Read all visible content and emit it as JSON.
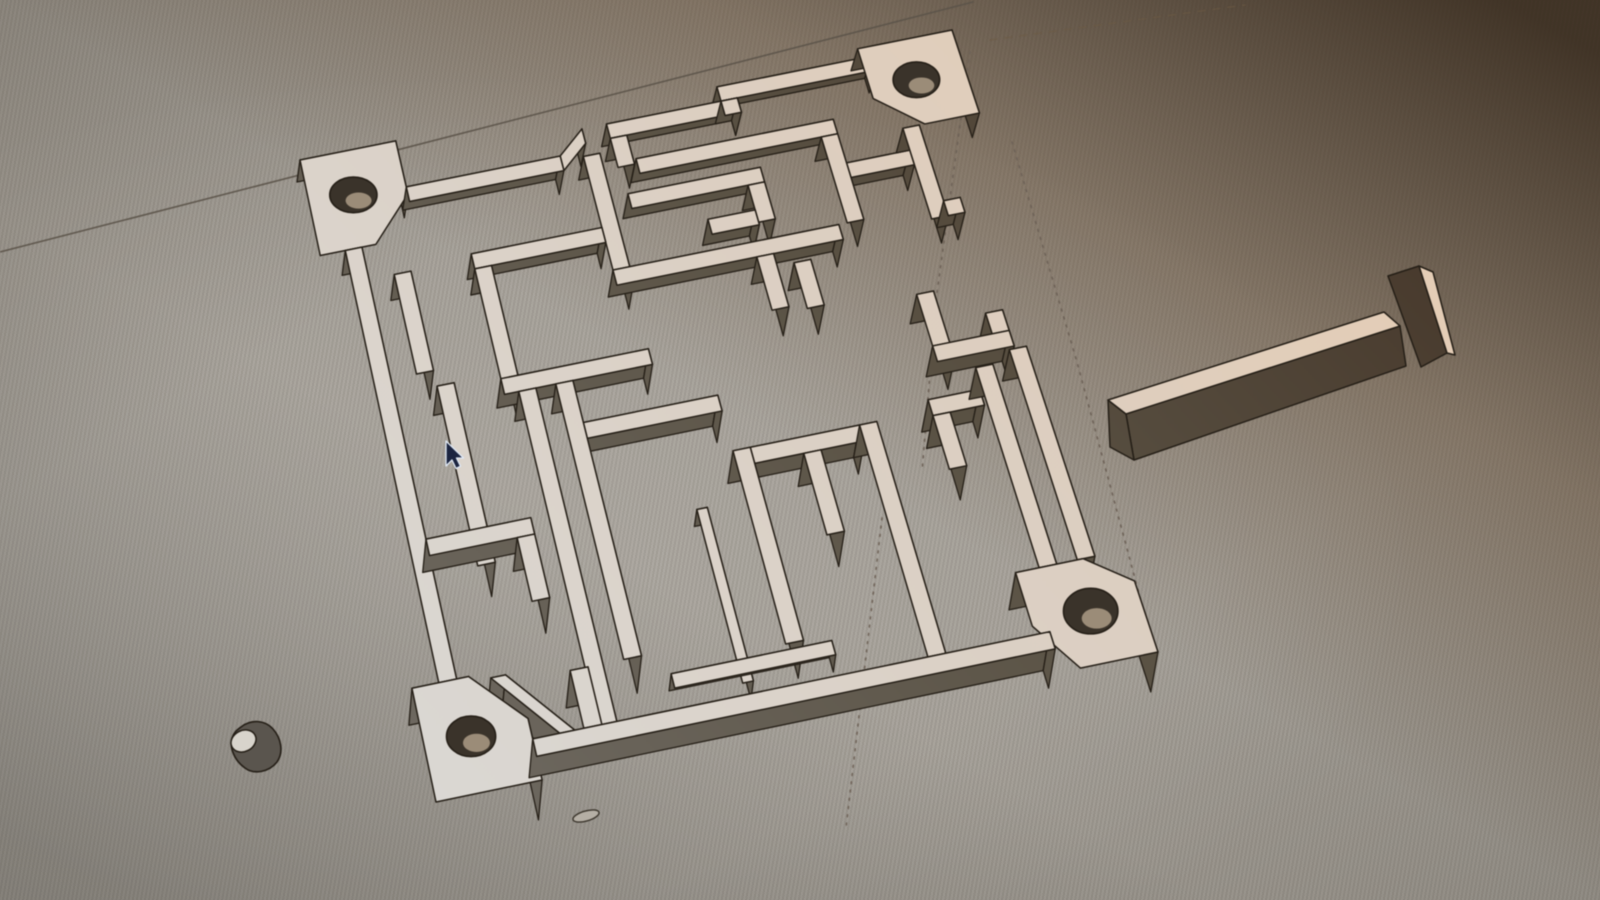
{
  "scene": {
    "board": {
      "size": 12,
      "quad": [
        [
          300,
          160
        ],
        [
          952,
          30
        ],
        [
          1158,
          652
        ],
        [
          436,
          802
        ]
      ],
      "ext": {
        "ex0": 3,
        "exu": 0.35,
        "ey0": 22,
        "eyv": 1.5
      }
    },
    "colors": {
      "outline": "#251f17",
      "hole": "#3a332a",
      "hole_glint": "#b4a38c",
      "top_stops": [
        [
          0,
          "#e6cdb4"
        ],
        [
          0.45,
          "#dccfc2"
        ],
        [
          1,
          "#dad8d4"
        ]
      ],
      "side_stops": [
        [
          0,
          "#46372a"
        ],
        [
          0.45,
          "#5a5244"
        ],
        [
          1,
          "#6f6a62"
        ]
      ],
      "cursor_fill": "#1b2440",
      "cursor_stroke": "#dfe8f4",
      "cyl_body": "#5a554e",
      "cyl_cap": "#d8d4cc",
      "oval_fill": "#b5afa5",
      "oval_stroke": "#3b352c"
    },
    "ground_lines": [
      {
        "name": "horizon-line",
        "pts": [
          [
            0,
            252
          ],
          [
            973,
            2
          ]
        ],
        "stroke": "#5b5349",
        "w": 1.6,
        "dash": "",
        "op": 0.9
      },
      {
        "name": "horizon-line-faint",
        "pts": [
          [
            990,
            40
          ],
          [
            1245,
            5
          ]
        ],
        "stroke": "#6d5b44",
        "w": 1.4,
        "dash": "7 8",
        "op": 0.55
      },
      {
        "name": "guide-line-dotted-1",
        "pts": [
          [
            970,
            52
          ],
          [
            936,
            300
          ],
          [
            922,
            472
          ]
        ],
        "stroke": "#6e6257",
        "w": 1.7,
        "dash": "1.8 6.5",
        "op": 0.95
      },
      {
        "name": "guide-line-dotted-2",
        "pts": [
          [
            1012,
            142
          ],
          [
            1077,
            362
          ],
          [
            1141,
            601
          ]
        ],
        "stroke": "#6e6257",
        "w": 1.7,
        "dash": "1.8 6.5",
        "op": 0.95
      },
      {
        "name": "guide-line-dotted-3",
        "pts": [
          [
            882,
            518
          ],
          [
            846,
            828
          ]
        ],
        "stroke": "#6e6257",
        "w": 1.7,
        "dash": "1.8 6.5",
        "op": 0.9
      }
    ],
    "pieces": [
      {
        "name": "corner-block-top-left",
        "poly": [
          [
            0,
            0
          ],
          [
            1.75,
            0
          ],
          [
            1.75,
            1.1
          ],
          [
            1.0,
            1.95
          ],
          [
            0,
            1.95
          ]
        ],
        "hole": [
          0.8,
          0.9,
          0.42
        ]
      },
      {
        "name": "corner-block-top-right",
        "poly": [
          [
            10.25,
            0
          ],
          [
            12,
            0
          ],
          [
            12,
            1.75
          ],
          [
            11.0,
            1.75
          ],
          [
            10.25,
            1.05
          ]
        ],
        "hole": [
          11.1,
          0.85,
          0.42
        ]
      },
      {
        "name": "corner-block-bottom-right",
        "poly": [
          [
            10.15,
            10.2
          ],
          [
            11.3,
            10.2
          ],
          [
            12,
            10.75
          ],
          [
            12,
            12
          ],
          [
            10.7,
            12
          ],
          [
            10.15,
            11.15
          ]
        ],
        "hole": [
          11.15,
          11.1,
          0.45
        ]
      },
      {
        "name": "corner-block-bottom-left",
        "poly": [
          [
            0,
            10.05
          ],
          [
            0.95,
            10.05
          ],
          [
            1.75,
            10.95
          ],
          [
            1.75,
            12
          ],
          [
            0,
            12
          ]
        ],
        "hole": [
          0.78,
          11.05,
          0.4
        ]
      },
      {
        "name": "perimeter-wall-top-left",
        "rect": [
          1.75,
          0.95,
          4.55,
          1.25
        ]
      },
      {
        "name": "perimeter-wall-top-jog",
        "poly": [
          [
            4.55,
            0.95
          ],
          [
            5.05,
            0.5
          ],
          [
            5.05,
            0.8
          ],
          [
            4.55,
            1.25
          ]
        ]
      },
      {
        "name": "perimeter-wall-top-mid",
        "rect": [
          5.5,
          0.5,
          7.9,
          0.8
        ]
      },
      {
        "name": "entrance-step-wall",
        "rect": [
          5.5,
          0.8,
          5.8,
          1.4
        ]
      },
      {
        "name": "perimeter-wall-top-right",
        "rect": [
          7.6,
          0.2,
          10.45,
          0.5
        ]
      },
      {
        "name": "perimeter-wall-top-step",
        "rect": [
          7.6,
          0.5,
          7.9,
          0.8
        ]
      },
      {
        "name": "maze-wall-inner-top",
        "rect": [
          5.85,
          1.3,
          9.45,
          1.6
        ]
      },
      {
        "name": "perimeter-wall-left",
        "rect": [
          0.45,
          1.95,
          0.75,
          10.05
        ]
      },
      {
        "name": "perimeter-wall-right-upper",
        "rect": [
          10.6,
          1.75,
          10.9,
          3.6
        ]
      },
      {
        "name": "perimeter-wall-right-step",
        "rect": [
          10.9,
          3.3,
          11.2,
          3.6
        ]
      },
      {
        "name": "right-u-wall-horizontal",
        "rect": [
          9.95,
          5.95,
          11.3,
          6.25
        ]
      },
      {
        "name": "right-u-wall-left",
        "rect": [
          9.95,
          4.95,
          10.25,
          6.25
        ]
      },
      {
        "name": "right-u-wall-right",
        "rect": [
          11.0,
          5.55,
          11.3,
          6.25
        ]
      },
      {
        "name": "perimeter-wall-right-lower-a",
        "rect": [
          10.55,
          6.5,
          10.85,
          10.2
        ]
      },
      {
        "name": "perimeter-wall-right-lower-b",
        "rect": [
          11.2,
          6.3,
          11.5,
          10.2
        ]
      },
      {
        "name": "perimeter-wall-bottom",
        "rect": [
          1.75,
          11.3,
          10.4,
          11.6
        ]
      },
      {
        "name": "spiral-wall-left",
        "rect": [
          4.95,
          1.05,
          5.25,
          3.65
        ]
      },
      {
        "name": "spiral-wall-bottom",
        "rect": [
          4.95,
          3.35,
          9.0,
          3.65
        ]
      },
      {
        "name": "spiral-wall-right",
        "rect": [
          9.15,
          1.6,
          9.45,
          3.35
        ]
      },
      {
        "name": "island-wall-top",
        "rect": [
          5.55,
          1.95,
          7.95,
          2.25
        ]
      },
      {
        "name": "island-wall-right",
        "rect": [
          7.65,
          2.25,
          7.95,
          3.0
        ]
      },
      {
        "name": "island-wall-bottom",
        "rect": [
          6.8,
          2.75,
          7.65,
          3.05
        ]
      },
      {
        "name": "t-stub-wall",
        "rect": [
          7.45,
          3.65,
          7.75,
          4.7
        ]
      },
      {
        "name": "t-stub-arm-wall",
        "rect": [
          8.05,
          3.9,
          8.35,
          4.8
        ]
      },
      {
        "name": "connector-wall-right",
        "rect": [
          9.45,
          2.2,
          10.6,
          2.5
        ]
      },
      {
        "name": "left-inner-wall-a",
        "rect": [
          1.2,
          2.6,
          1.5,
          4.55
        ]
      },
      {
        "name": "left-inner-wall-b",
        "rect": [
          1.5,
          4.85,
          1.8,
          8.2
        ]
      },
      {
        "name": "mid-left-horizontal-wall",
        "rect": [
          2.6,
          2.5,
          4.95,
          2.8
        ]
      },
      {
        "name": "mid-left-vertical-riser",
        "rect": [
          2.6,
          2.8,
          2.9,
          5.25
        ]
      },
      {
        "name": "mid-horizontal-wall-upper",
        "rect": [
          2.6,
          4.95,
          5.2,
          5.25
        ]
      },
      {
        "name": "mid-horizontal-wall-lower",
        "rect": [
          3.8,
          6.05,
          6.15,
          6.35
        ]
      },
      {
        "name": "corridor-wall-left",
        "rect": [
          2.85,
          5.25,
          3.15,
          11.3
        ]
      },
      {
        "name": "corridor-wall-right",
        "rect": [
          3.5,
          5.25,
          3.8,
          10.3
        ]
      },
      {
        "name": "left-lower-horizontal-wall",
        "rect": [
          0.75,
          7.55,
          2.55,
          7.85
        ]
      },
      {
        "name": "left-lower-corner-wall",
        "rect": [
          2.25,
          7.85,
          2.55,
          9.0
        ]
      },
      {
        "name": "bottom-stub-wall-left",
        "rect": [
          2.6,
          10.3,
          2.9,
          11.3
        ]
      },
      {
        "name": "h-structure-left-wall",
        "rect": [
          6.15,
          7.1,
          6.45,
          10.6
        ]
      },
      {
        "name": "h-structure-top-wall",
        "rect": [
          6.45,
          7.1,
          8.35,
          7.4
        ]
      },
      {
        "name": "h-structure-middle-stub",
        "rect": [
          7.3,
          7.4,
          7.6,
          8.9
        ]
      },
      {
        "name": "h-structure-right-wall",
        "rect": [
          8.35,
          7.1,
          8.65,
          11.3
        ]
      },
      {
        "name": "right-l-wall-horizontal",
        "rect": [
          9.6,
          6.9,
          10.5,
          7.2
        ]
      },
      {
        "name": "right-l-wall-vertical",
        "rect": [
          9.6,
          7.2,
          9.9,
          8.2
        ]
      },
      {
        "name": "thin-partition-vertical",
        "rect": [
          5.3,
          8.0,
          5.48,
          11.1
        ],
        "h": 0.5
      },
      {
        "name": "low-partition-horizontal",
        "rect": [
          4.2,
          10.7,
          6.9,
          10.95
        ],
        "h": 0.45
      },
      {
        "name": "diagonal-chamfer-wall",
        "poly": [
          [
            1.3,
            10.15
          ],
          [
            1.55,
            10.15
          ],
          [
            2.45,
            11.3
          ],
          [
            2.2,
            11.3
          ]
        ]
      }
    ],
    "tbar": {
      "polys": [
        {
          "f": "side",
          "pts": [
            [
              1388,
              276
            ],
            [
              1419,
              266
            ],
            [
              1447,
              353
            ],
            [
              1421,
              367
            ]
          ]
        },
        {
          "f": "top",
          "pts": [
            [
              1419,
              266
            ],
            [
              1433,
              272
            ],
            [
              1455,
              355
            ],
            [
              1447,
              353
            ]
          ]
        },
        {
          "f": "side",
          "pts": [
            [
              1126,
              414
            ],
            [
              1400,
              326
            ],
            [
              1406,
              366
            ],
            [
              1134,
              460
            ]
          ]
        },
        {
          "f": "side",
          "pts": [
            [
              1108,
              400
            ],
            [
              1126,
              414
            ],
            [
              1134,
              460
            ],
            [
              1110,
              447
            ]
          ]
        },
        {
          "f": "top",
          "pts": [
            [
              1108,
              400
            ],
            [
              1384,
              312
            ],
            [
              1400,
              326
            ],
            [
              1126,
              414
            ]
          ]
        }
      ]
    },
    "cylinder": {
      "body_path": "M 241,727 C 251,719 265,720 273,729 C 281,738 284,752 277,762 C 269,772 254,775 245,768 C 235,761 229,748 232,738 C 234,732 237,730 241,727 Z",
      "cap": {
        "cx": 243.5,
        "cy": 741,
        "rx": 13,
        "ry": 10.5,
        "rot": -27
      }
    },
    "bottom_oval": {
      "cx": 586,
      "cy": 816,
      "rx": 13.5,
      "ry": 5,
      "rot": -16
    },
    "cursor": {
      "pts": [
        [
          446,
          441
        ],
        [
          446,
          466
        ],
        [
          452,
          460
        ],
        [
          456,
          468.5
        ],
        [
          460.5,
          466.2
        ],
        [
          456.5,
          458
        ],
        [
          463.5,
          458
        ]
      ]
    }
  }
}
